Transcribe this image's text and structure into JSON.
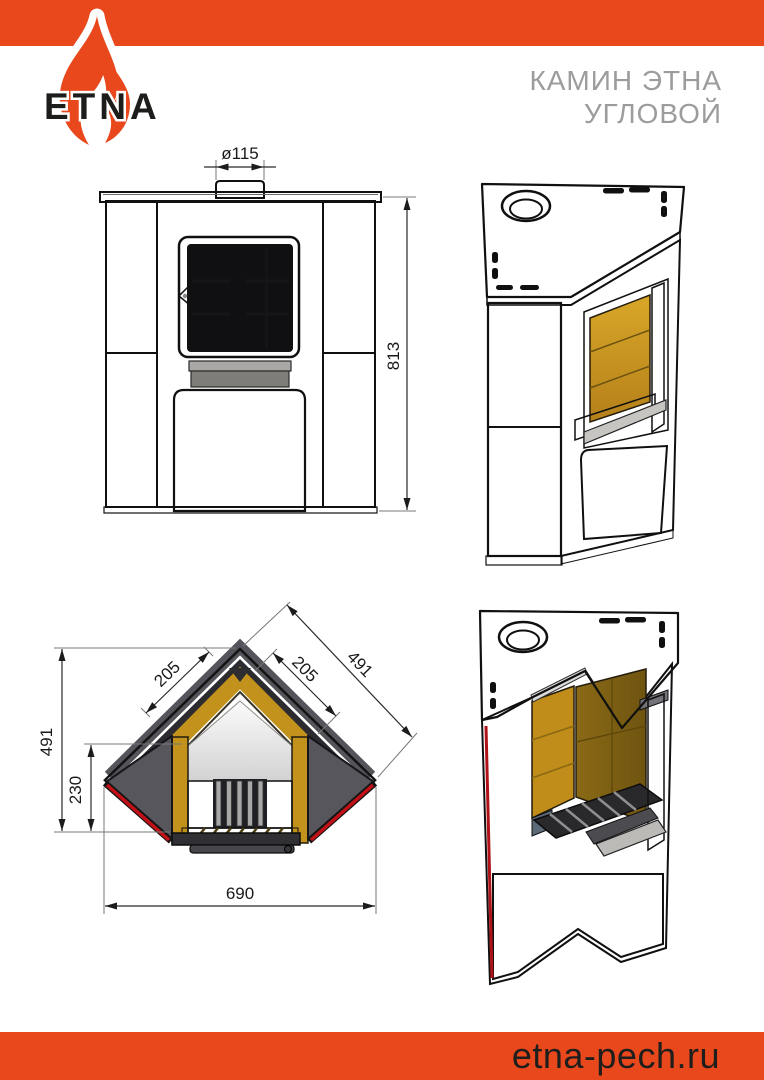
{
  "brand": {
    "logo_text": "ETNA",
    "website": "etna-pech.ru"
  },
  "header": {
    "title_line1": "КАМИН ЭТНА",
    "title_line2": "УГЛОВОЙ"
  },
  "dimensions": {
    "front": {
      "chimney_diameter": "ø115",
      "height": "813"
    },
    "plan": {
      "depth": "491",
      "firebox_depth": "230",
      "glass_left": "205",
      "glass_right": "205",
      "side": "491",
      "width": "690"
    }
  },
  "colors": {
    "accent_orange": "#e8481c",
    "panel_red_dark": "#a81116",
    "panel_red_bright": "#d01a1c",
    "body_gray": "#4b4a47",
    "brick_amber": "#c2921c",
    "title_gray": "#9c9c9c",
    "footer_text": "#1e1e1c"
  }
}
